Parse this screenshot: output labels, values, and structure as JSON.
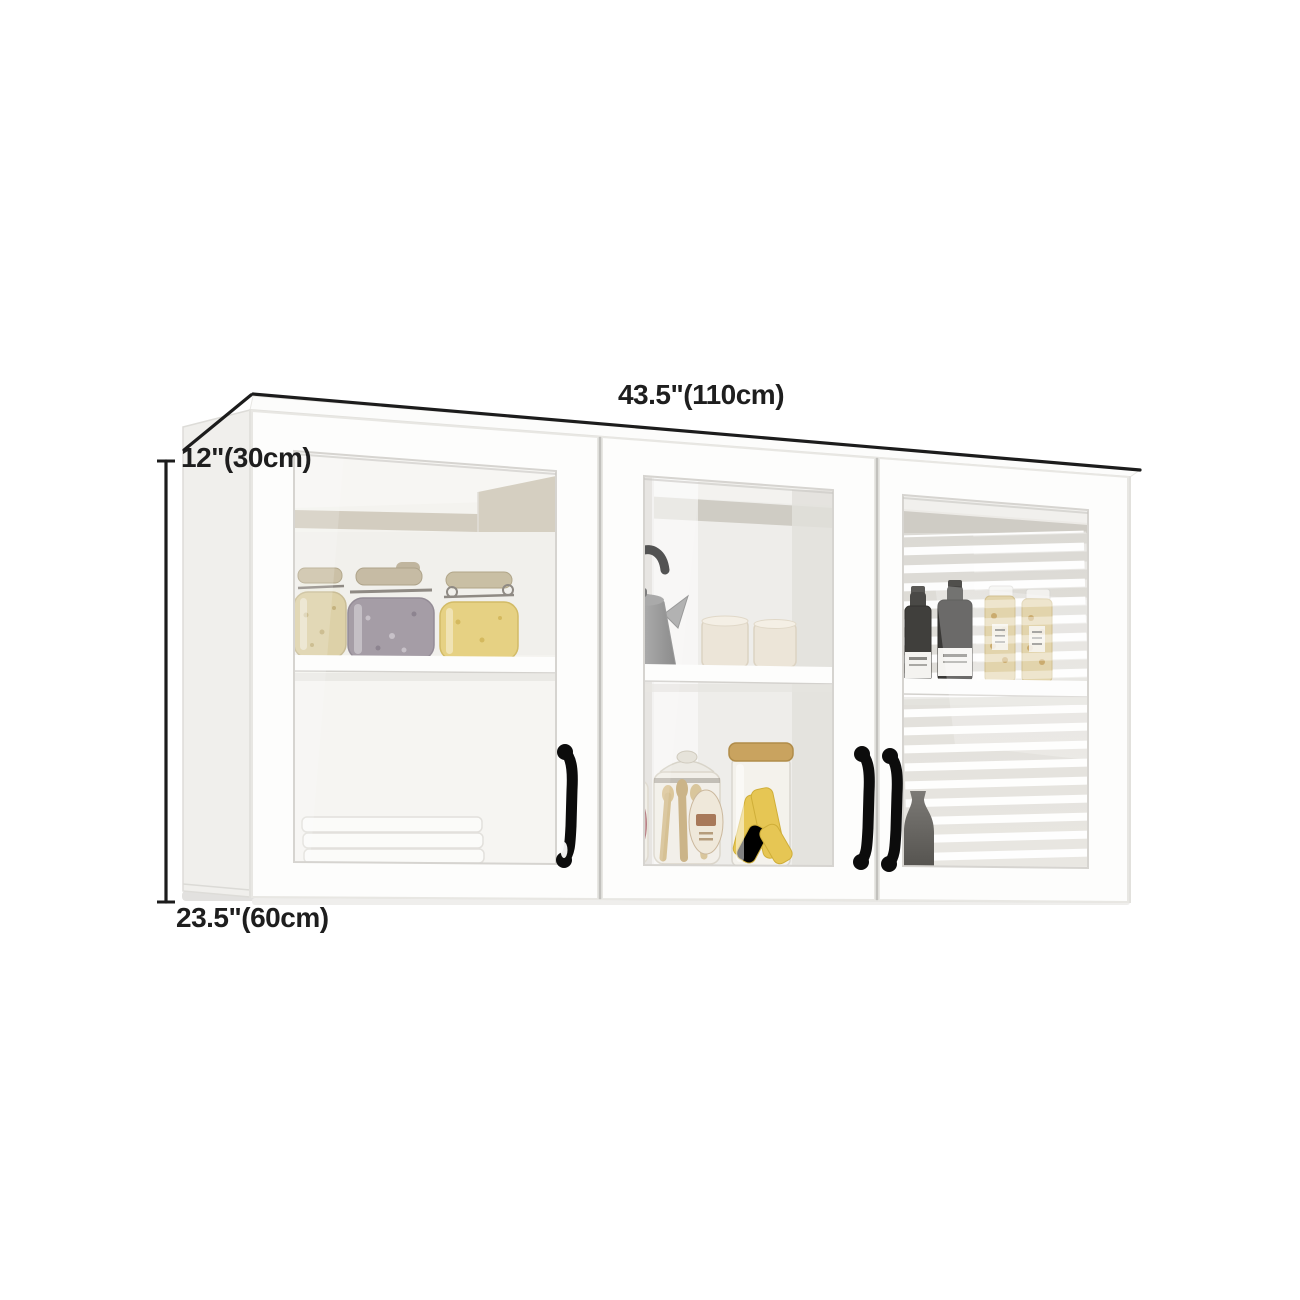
{
  "scene": {
    "background_color": "#ffffff",
    "description": "White 3-door glass-front wall-mounted kitchen cabinet shown with dimension annotations",
    "dimension_labels": {
      "width": "43.5\"(110cm)",
      "depth": "12\"(30cm)",
      "height": "23.5\"(60cm)"
    },
    "annotation": {
      "line_color": "#1c1c1c",
      "text_color": "#1e1e1e"
    },
    "cabinet": {
      "body_color": "#fcfcfb",
      "side_panel_color": "#f0efec",
      "outline_color": "#e2e1dd",
      "handle_color": "#0c0c0c",
      "interior_band_color": "#cfc9ba",
      "doors": [
        {
          "position": "left",
          "handle": "right-edge",
          "upper_shelf_items": [
            "cream speckled clip-top jar",
            "gray speckled clip-top jar",
            "yellow cornmeal clip-top jar"
          ],
          "lower_items": [
            "stack of three white trays"
          ]
        },
        {
          "position": "middle",
          "handle": "right-edge",
          "upper_shelf_items": [
            "gray kettle",
            "two cream canisters"
          ],
          "lower_items": [
            "bottle with rose label",
            "jar of wooden utensils",
            "cork-lid jar of yellow pasta"
          ]
        },
        {
          "position": "right",
          "handle": "left-edge",
          "upper_shelf_items": [
            "two dark sauce bottles",
            "two golden spice jars"
          ],
          "lower_items": [
            "dark gray vase"
          ],
          "reflection": "window blinds"
        }
      ]
    }
  }
}
